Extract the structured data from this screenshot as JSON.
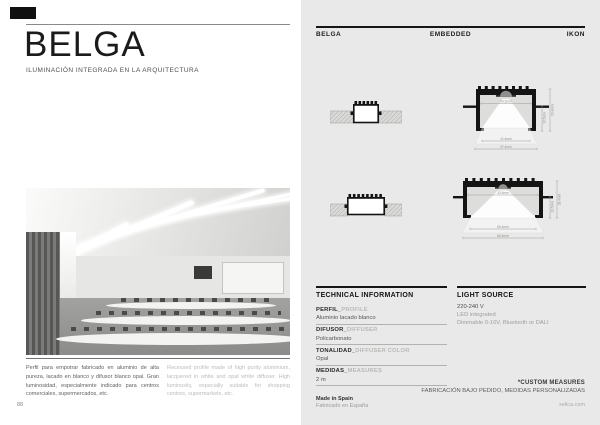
{
  "colors": {
    "panel_bg": "#e9e9e9",
    "ink": "#141414",
    "muted_text": "#9d9d9b"
  },
  "left_page": {
    "title": "BELGA",
    "subtitle": "ILUMINACIÓN INTEGRADA EN LA ARQUITECTURA",
    "description_es": "Perfil para empotrar fabricado en aluminio de alta pureza, lacado en blanco y difusor blanco opal. Gran luminosidad, especialmente indicado para centros comerciales, supermercados, etc.",
    "description_en": "Recessed profile made of high purity aluminium, lacquered in white and opal white diffuser. High luminosity, especially suitable for shopping centres, supermarkets, etc.",
    "page_number": "88"
  },
  "right_page": {
    "header": {
      "product": "BELGA",
      "category": "EMBEDDED",
      "collection": "IKON"
    },
    "drawings": {
      "row1": {
        "inner_width": "24.5mm",
        "height_inner": "13.5mm",
        "height_outer": "29.4mm",
        "width_inner": "41.4mm",
        "width_outer": "47.4mm"
      },
      "row2": {
        "inner_width": "43.5mm",
        "height_inner": "13.5mm",
        "height_outer": "28.4mm",
        "width_inner": "60.4mm",
        "width_outer": "66.4mm"
      }
    },
    "technical": {
      "title": "TECHNICAL INFORMATION",
      "rows": [
        {
          "label_es": "PERFIL_",
          "label_en": "PROFILE",
          "value": "Aluminio lacado blanco"
        },
        {
          "label_es": "DIFUSOR_",
          "label_en": "DIFFUSER",
          "value": "Policarbonato"
        },
        {
          "label_es": "TONALIDAD_",
          "label_en": "DIFFUSER COLOR",
          "value": "Opal"
        },
        {
          "label_es": "MEDIDAS_",
          "label_en": "MEASURES",
          "value": "2 m"
        }
      ]
    },
    "light_source": {
      "title": "LIGHT SOURCE",
      "voltage": "220-240 V",
      "type": "LED integrated",
      "dimming": "Dimmable 0-10V, Bluetooth or DALI"
    },
    "custom_note": {
      "line1": "*CUSTOM MEASURES",
      "line2": "FABRICACIÓN BAJO PEDIDO, MEDIDAS PERSONALIZADAS"
    },
    "origin": {
      "en": "Made in Spain",
      "es": "Fabricado en España"
    },
    "website": "xelica.com"
  }
}
